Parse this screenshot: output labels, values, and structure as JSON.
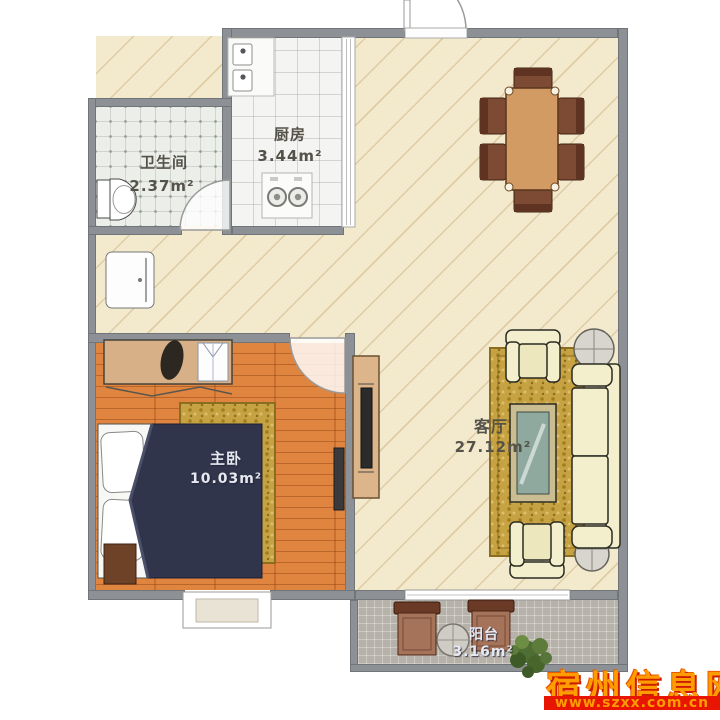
{
  "title": "两室户型图 (apartment floor plan)",
  "rooms": [
    {
      "id": "kitchen",
      "name": "厨房",
      "area": "3.44m²"
    },
    {
      "id": "bathroom",
      "name": "卫生间",
      "area": "2.37m²"
    },
    {
      "id": "master-bedroom",
      "name": "主卧",
      "area": "10.03m²"
    },
    {
      "id": "living-room",
      "name": "客厅",
      "area": "27.12m²"
    },
    {
      "id": "balcony",
      "name": "阳台",
      "area": "3.16m²"
    }
  ],
  "watermark": {
    "site": "宿州信息网",
    "url": "www.szxx.com.cn"
  },
  "colors": {
    "watermark_text": "#ff9c00",
    "watermark_bar": "#e81500",
    "wall": "#8d9195",
    "living_floor": "#f3e9cd",
    "bedroom_wood": "#e08540",
    "rug_gold": "#c6a242",
    "sofa_cream": "#f3efcd",
    "duvet_navy": "#31354b"
  }
}
